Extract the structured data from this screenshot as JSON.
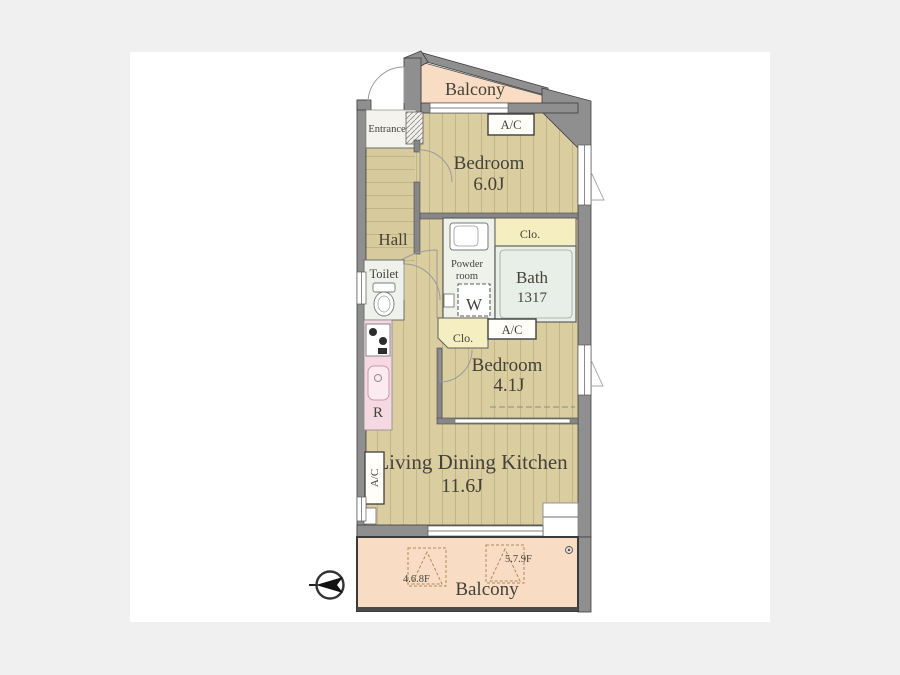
{
  "plan": {
    "balcony_top": {
      "label": "Balcony"
    },
    "entrance": {
      "label": "Entrance"
    },
    "bedroom_6": {
      "label": "Bedroom",
      "size": "6.0J",
      "ac_label": "A/C"
    },
    "hall": {
      "label": "Hall"
    },
    "toilet": {
      "label": "Toilet"
    },
    "powder_room": {
      "label_line1": "Powder",
      "label_line2": "room"
    },
    "closet_upper": {
      "label": "Clo."
    },
    "bath": {
      "label": "Bath",
      "size": "1317"
    },
    "washer": {
      "label": "W"
    },
    "closet_lower": {
      "label": "Clo."
    },
    "bedroom_4": {
      "label": "Bedroom",
      "size": "4.1J",
      "ac_label": "A/C"
    },
    "kitchen": {
      "fridge_label": "R"
    },
    "ldk": {
      "label": "Living Dining Kitchen",
      "size": "11.6J",
      "ac_label": "A/C"
    },
    "balcony_bottom": {
      "label": "Balcony",
      "hatch_left_label": "4.6.8F",
      "hatch_right_label": "5.7.9F"
    }
  },
  "icons": {
    "compass": "north-arrow-icon",
    "toilet": "toilet-icon",
    "stove": "stove-icon",
    "sink": "sink-icon",
    "washbasin": "washbasin-icon",
    "drain": "drain-icon"
  },
  "colors": {
    "background": "#f0f0f0",
    "canvas": "#ffffff",
    "wall": "#8f8f8f",
    "floor": "#dacda0",
    "floor_stripe": "#c2b588",
    "balcony": "#f8dcc3",
    "kitchen": "#f6d8e2",
    "closet": "#f4eec0",
    "bath": "#e8efe8",
    "text": "#454239"
  }
}
